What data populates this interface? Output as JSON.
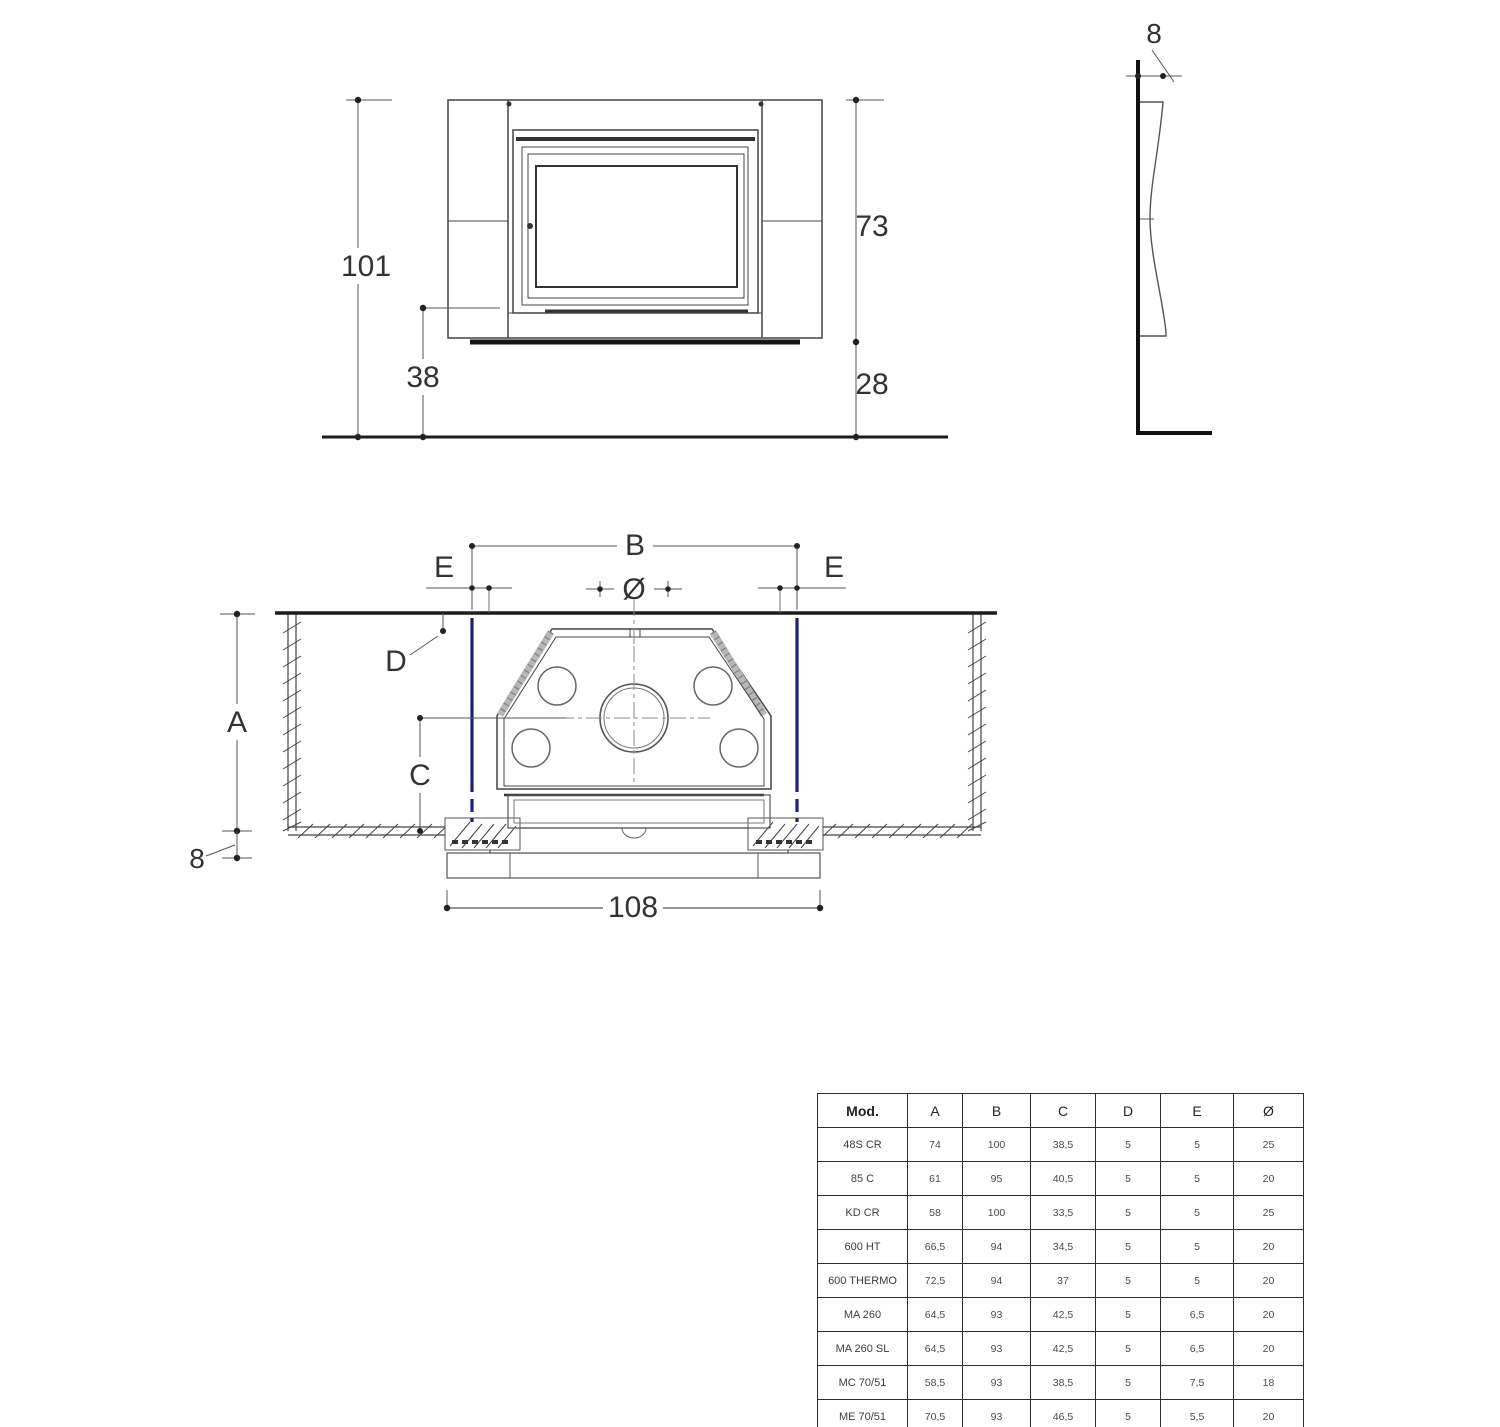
{
  "front_view": {
    "dim_height_total": "101",
    "dim_opening_height": "73",
    "dim_firebox_floor_height": "38",
    "dim_hearth_height": "28"
  },
  "side_view": {
    "dim_panel_thickness": "8"
  },
  "plan_view": {
    "label_width_b": "B",
    "label_clearance_e_left": "E",
    "label_clearance_e_right": "E",
    "label_flue_diameter": "Ø",
    "label_depth_d": "D",
    "label_niche_depth_a": "A",
    "label_center_depth_c": "C",
    "dim_wall_thickness": "8",
    "dim_base_width": "108"
  },
  "colors": {
    "frame_line_blue": "#20207a",
    "line_dark": "#1c1c1c",
    "line_mid": "#555555"
  },
  "table": {
    "headers": [
      "Mod.",
      "A",
      "B",
      "C",
      "D",
      "E",
      "Ø"
    ],
    "rows": [
      [
        "48S CR",
        "74",
        "100",
        "38,5",
        "5",
        "5",
        "25"
      ],
      [
        "85 C",
        "61",
        "95",
        "40,5",
        "5",
        "5",
        "20"
      ],
      [
        "KD CR",
        "58",
        "100",
        "33,5",
        "5",
        "5",
        "25"
      ],
      [
        "600 HT",
        "66,5",
        "94",
        "34,5",
        "5",
        "5",
        "20"
      ],
      [
        "600 THERMO",
        "72,5",
        "94",
        "37",
        "5",
        "5",
        "20"
      ],
      [
        "MA 260",
        "64,5",
        "93",
        "42,5",
        "5",
        "6,5",
        "20"
      ],
      [
        "MA 260 SL",
        "64,5",
        "93",
        "42,5",
        "5",
        "6,5",
        "20"
      ],
      [
        "MC 70/51",
        "58,5",
        "93",
        "38,5",
        "5",
        "7,5",
        "18"
      ],
      [
        "ME 70/51",
        "70,5",
        "93",
        "46,5",
        "5",
        "5,5",
        "20"
      ]
    ]
  }
}
